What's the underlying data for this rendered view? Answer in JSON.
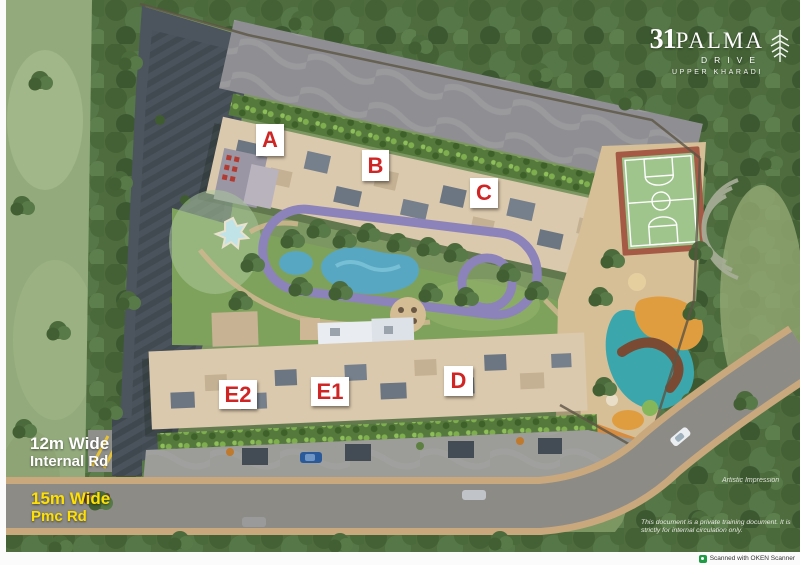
{
  "logo": {
    "number": "31",
    "name": "PALMA",
    "sub": "DRIVE",
    "location": "UPPER KHARADI",
    "icon": "palm-leaf-icon",
    "color": "#ffffff"
  },
  "towers": [
    {
      "label": "A"
    },
    {
      "label": "B"
    },
    {
      "label": "C"
    },
    {
      "label": "D"
    },
    {
      "label": "E1"
    },
    {
      "label": "E2"
    }
  ],
  "road_labels": {
    "internal": {
      "line1": "12m Wide",
      "line2": "Internal Rd",
      "color": "#ffffff"
    },
    "pmc": {
      "line1": "15m Wide",
      "line2": "Pmc Rd",
      "color": "#ffe000"
    }
  },
  "watermark": "Artistic Impression",
  "disclaimer": {
    "line1": "This document is a private training document.",
    "line2": "It is strictly for internal circulation only."
  },
  "scanner_note": "Scanned with OKEN Scanner",
  "site_features": [
    "jogging-track",
    "swimming-pool",
    "kids-pool",
    "basketball-court",
    "kids-play-area",
    "amphitheatre",
    "parking",
    "internal-road",
    "pmc-road"
  ],
  "colors": {
    "tower_label": "#d02525",
    "building_beige": "#dbc9ad",
    "jogging_track_purple": "#8d83bb",
    "pool_blue": "#58a7c2",
    "lawn_green": "#7ea25b",
    "forest_green": "#4e6c3d",
    "road_gray": "#8d8b86",
    "court_green": "#9fc58c",
    "court_border": "#a55a46",
    "scanner_icon_green": "#1f9d44"
  }
}
